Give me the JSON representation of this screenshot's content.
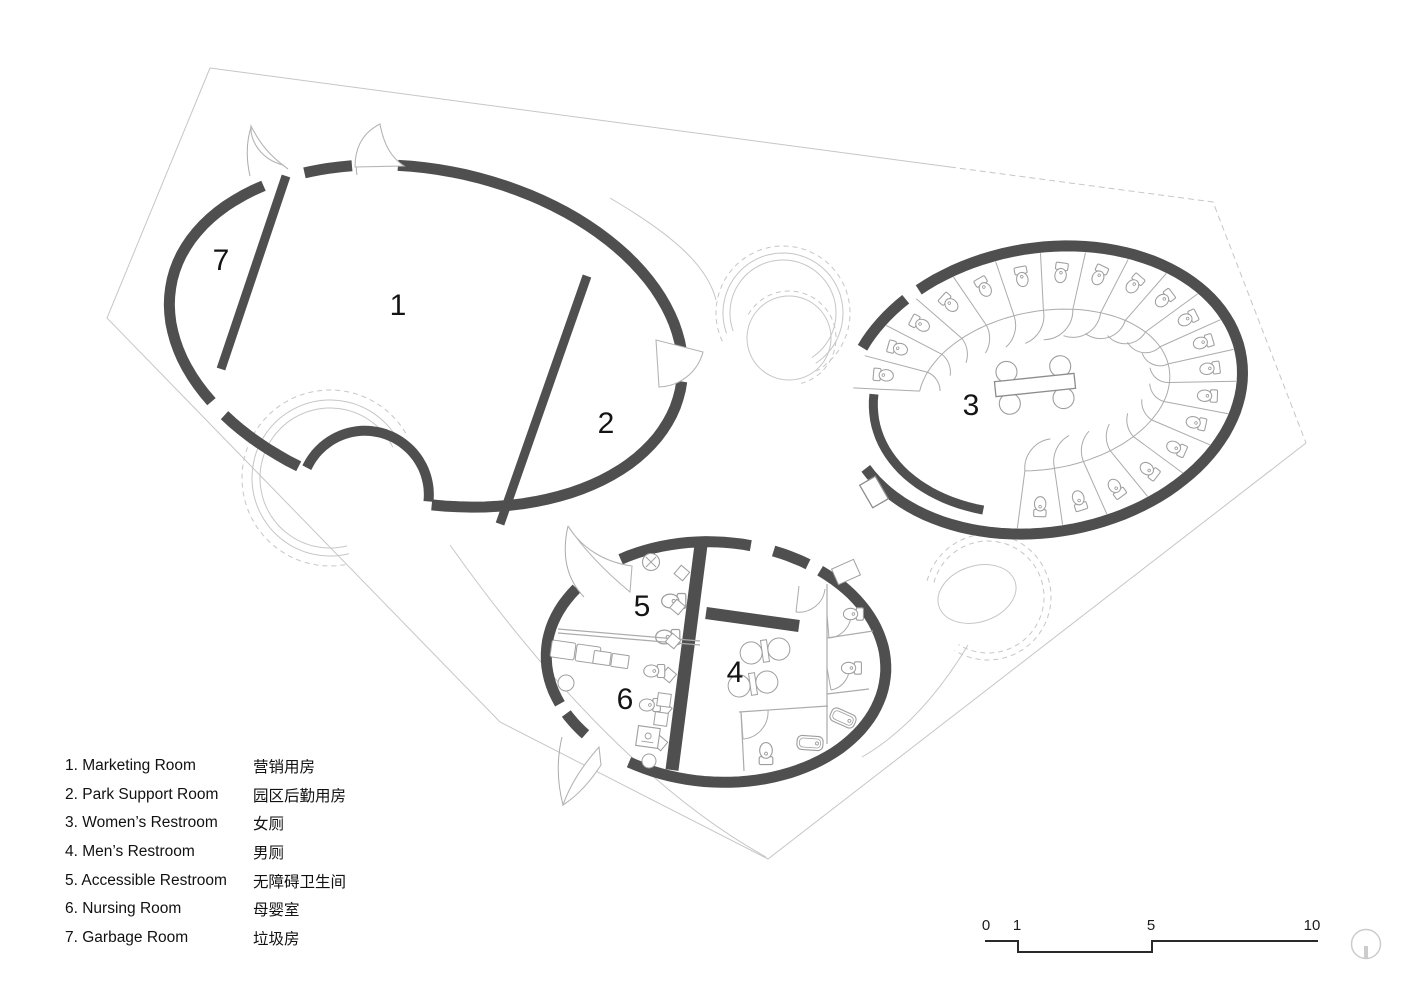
{
  "plan": {
    "rooms": [
      {
        "num": "1",
        "name_en": "Marketing Room",
        "name_zh": "营销用房",
        "label_x": 398,
        "label_y": 306
      },
      {
        "num": "2",
        "name_en": "Park Support Room",
        "name_zh": "园区后勤用房",
        "label_x": 606,
        "label_y": 424
      },
      {
        "num": "3",
        "name_en": "Women’s Restroom",
        "name_zh": "女厕",
        "label_x": 971,
        "label_y": 406
      },
      {
        "num": "4",
        "name_en": "Men’s Restroom",
        "name_zh": "男厕",
        "label_x": 735,
        "label_y": 673
      },
      {
        "num": "5",
        "name_en": "Accessible Restroom",
        "name_zh": "无障碍卫生间",
        "label_x": 642,
        "label_y": 607
      },
      {
        "num": "6",
        "name_en": "Nursing Room",
        "name_zh": "母婴室",
        "label_x": 625,
        "label_y": 700
      },
      {
        "num": "7",
        "name_en": "Garbage Room",
        "name_zh": "垃圾房",
        "label_x": 221,
        "label_y": 261
      }
    ]
  },
  "legend": {
    "items": [
      {
        "num": "1.",
        "en": "Marketing Room",
        "zh": "营销用房"
      },
      {
        "num": "2.",
        "en": "Park Support Room",
        "zh": "园区后勤用房"
      },
      {
        "num": "3.",
        "en": "Women’s Restroom",
        "zh": "女厕"
      },
      {
        "num": "4.",
        "en": "Men’s Restroom",
        "zh": "男厕"
      },
      {
        "num": "5.",
        "en": "Accessible Restroom",
        "zh": "无障碍卫生间"
      },
      {
        "num": "6.",
        "en": "Nursing Room",
        "zh": "母婴室"
      },
      {
        "num": "7.",
        "en": "Garbage Room",
        "zh": "垃圾房"
      }
    ]
  },
  "scalebar": {
    "labels": [
      "0",
      "1",
      "5",
      "10"
    ]
  },
  "colors": {
    "wall": "#4f4f4f",
    "thin_line": "#c6c6c6",
    "fixture": "#9e9e9e",
    "light_partition": "#ababab",
    "text": "#141414",
    "scalebar_line": "#2a2a2a",
    "logo": "#cccccc"
  }
}
